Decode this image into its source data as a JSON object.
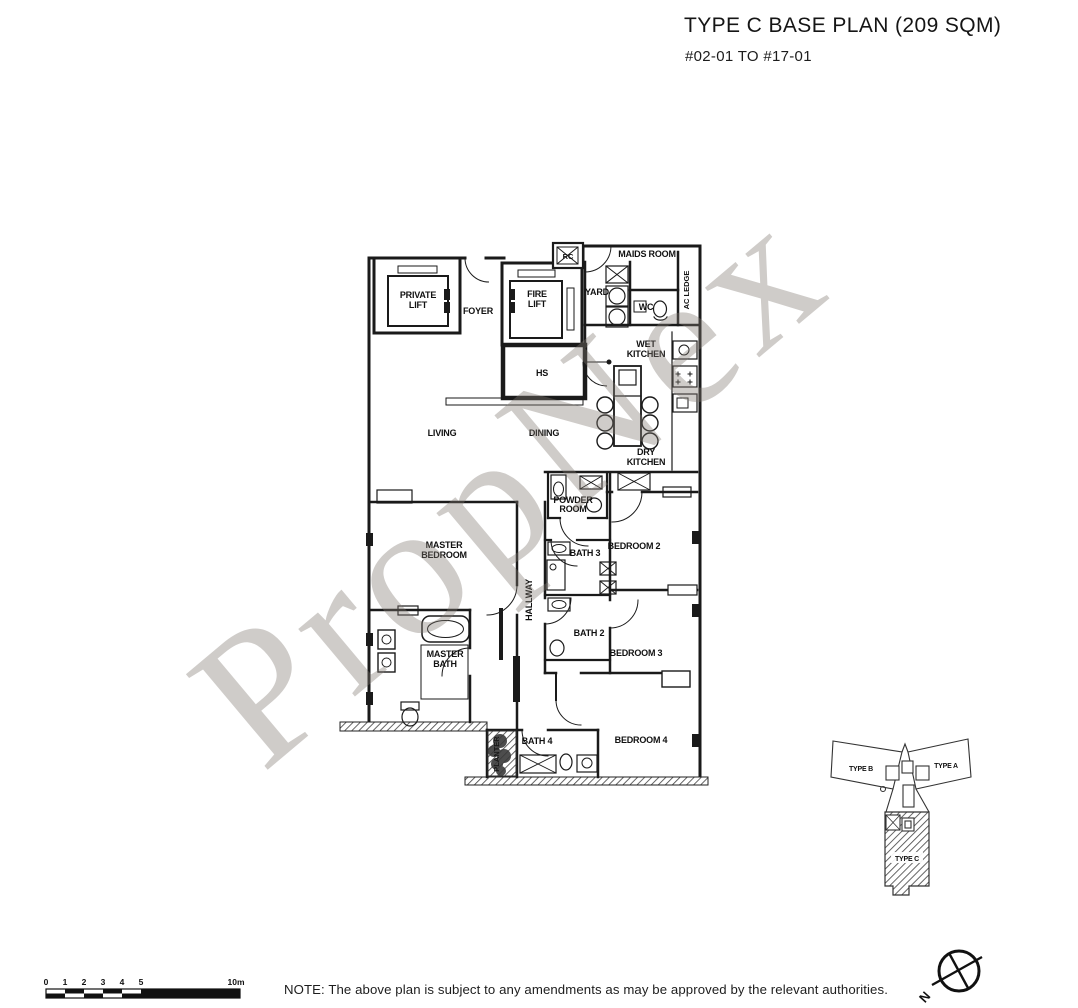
{
  "header": {
    "title": "TYPE C BASE PLAN (209 SQM)",
    "subtitle": "#02-01 TO #17-01"
  },
  "watermark": "PropNex",
  "note": "NOTE: The above plan is subject to any amendments as may be approved by the relevant authorities.",
  "rooms": {
    "private_lift_1": "PRIVATE",
    "private_lift_2": "LIFT",
    "foyer": "FOYER",
    "fire_lift_1": "FIRE",
    "fire_lift_2": "LIFT",
    "rc": "RC",
    "maids_room": "MAIDS ROOM",
    "yard": "YARD",
    "wc": "WC",
    "ac_ledge": "AC LEDGE",
    "wet_kitchen_1": "WET",
    "wet_kitchen_2": "KITCHEN",
    "hs": "HS",
    "living": "LIVING",
    "dining": "DINING",
    "dry_kitchen_1": "DRY",
    "dry_kitchen_2": "KITCHEN",
    "powder_room_1": "POWDER",
    "powder_room_2": "ROOM",
    "master_bedroom_1": "MASTER",
    "master_bedroom_2": "BEDROOM",
    "bath_3": "BATH 3",
    "bedroom_2": "BEDROOM 2",
    "hallway": "HALLWAY",
    "bath_2": "BATH 2",
    "bedroom_3": "BEDROOM 3",
    "master_bath_1": "MASTER",
    "master_bath_2": "BATH",
    "bath_4": "BATH 4",
    "bedroom_4": "BEDROOM 4",
    "planter": "PLANTER"
  },
  "key_plan": {
    "type_b": "TYPE B",
    "type_a": "TYPE A",
    "type_c": "TYPE C"
  },
  "compass": {
    "north": "N"
  },
  "scale_bar": {
    "t0": "0",
    "t1": "1",
    "t2": "2",
    "t3": "3",
    "t4": "4",
    "t5": "5",
    "t10": "10m"
  },
  "colors": {
    "line": "#1a1a1a",
    "watermark": "rgba(128,122,114,0.38)"
  }
}
